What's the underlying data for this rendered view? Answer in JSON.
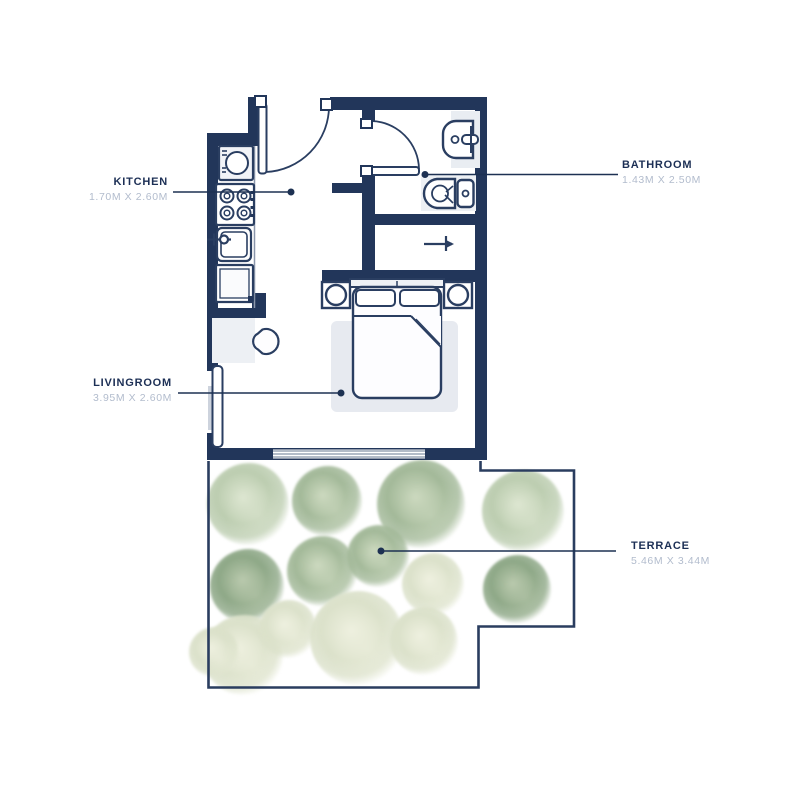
{
  "rooms": {
    "kitchen": {
      "label": "KITCHEN",
      "dims": "1.70M X 2.60M"
    },
    "bathroom": {
      "label": "BATHROOM",
      "dims": "1.43M X 2.50M"
    },
    "livingroom": {
      "label": "LIVINGROOM",
      "dims": "3.95M X 2.60M"
    },
    "terrace": {
      "label": "TERRACE",
      "dims": "5.46M X 3.44M"
    }
  },
  "colors": {
    "wall_navy": "#22365a",
    "fixture_stroke": "#2a3e61",
    "leader_line": "#1d3152",
    "label_dark": "#1c2f55",
    "label_light": "#b2bccd",
    "rug": "#e7eaf0",
    "backdrop_gray": "#e9edf2",
    "window_gray": "#9aa6b6",
    "bush": {
      "dark": {
        "base": "#8ea887",
        "light": "#b9c9ad"
      },
      "mid": {
        "base": "#a3b999",
        "light": "#ccd9bf"
      },
      "pale": {
        "base": "#bccdb0",
        "light": "#dde6d1"
      },
      "paley": {
        "base": "#dbe1ca",
        "light": "#eef0df"
      }
    }
  },
  "terrace_bushes": [
    {
      "cx": 248,
      "cy": 504,
      "r": 41,
      "tone": "pale"
    },
    {
      "cx": 327,
      "cy": 501,
      "r": 35,
      "tone": "mid"
    },
    {
      "cx": 421,
      "cy": 504,
      "r": 44,
      "tone": "mid"
    },
    {
      "cx": 523,
      "cy": 511,
      "r": 41,
      "tone": "pale"
    },
    {
      "cx": 247,
      "cy": 586,
      "r": 37,
      "tone": "dark"
    },
    {
      "cx": 322,
      "cy": 571,
      "r": 35,
      "tone": "mid"
    },
    {
      "cx": 378,
      "cy": 556,
      "r": 31,
      "tone": "mid"
    },
    {
      "cx": 433,
      "cy": 584,
      "r": 31,
      "tone": "paley"
    },
    {
      "cx": 517,
      "cy": 589,
      "r": 34,
      "tone": "dark"
    },
    {
      "cx": 243,
      "cy": 655,
      "r": 40,
      "tone": "paley"
    },
    {
      "cx": 288,
      "cy": 629,
      "r": 29,
      "tone": "paley"
    },
    {
      "cx": 357,
      "cy": 638,
      "r": 47,
      "tone": "paley"
    },
    {
      "cx": 424,
      "cy": 641,
      "r": 34,
      "tone": "paley"
    },
    {
      "cx": 214,
      "cy": 652,
      "r": 25,
      "tone": "paley"
    }
  ]
}
